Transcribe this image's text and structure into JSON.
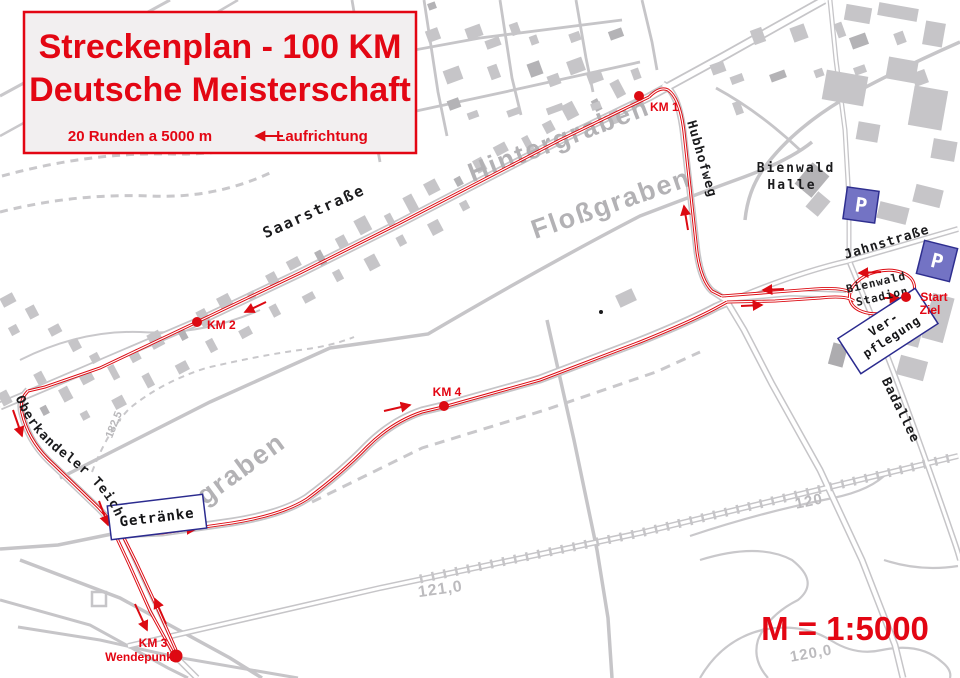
{
  "legend": {
    "title_line1": "Streckenplan - 100 KM",
    "title_line2": "Deutsche Meisterschaft",
    "laps_note": "20 Runden a 5000 m",
    "direction_label": "Laufrichtung"
  },
  "scale_label": "M = 1:5000",
  "streets": {
    "saarstrasse": "Saarstraße",
    "hubhofweg": "Hubhofweg",
    "jahnstrasse": "Jahnstraße",
    "badallee": "Badallee",
    "oberkandeler_teich": "Oberkandeler Teich"
  },
  "waterways": {
    "hintergraben": "Hintergraben",
    "flossgraben": "Floßgraben",
    "iggraben": "iggraben"
  },
  "places": {
    "halle_line1": "Bienwald",
    "halle_line2": "Halle",
    "stadion_line1": "Bienwald",
    "stadion_line2": "Stadion",
    "verpflegung_line1": "Ver-",
    "verpflegung_line2": "pflegung",
    "getraenke": "Getränke",
    "parking": "P"
  },
  "markers": {
    "km1": "KM 1",
    "km2": "KM 2",
    "km3": "KM 3",
    "km3_sub": "Wendepunkt",
    "km4": "KM 4",
    "start_line1": "Start",
    "start_line2": "Ziel"
  },
  "contours": {
    "c121": "121,0",
    "c120": "120",
    "c120_0": "120,0",
    "c182": "182,5"
  },
  "colors": {
    "route_red": "#dc0a12",
    "title_red": "#e30613",
    "map_gray": "#c6c5c8",
    "label_gray": "#b3b2b5",
    "parking_fill": "#7373c4",
    "parking_border": "#2e2e8f",
    "box_border": "#2b2b8f"
  }
}
